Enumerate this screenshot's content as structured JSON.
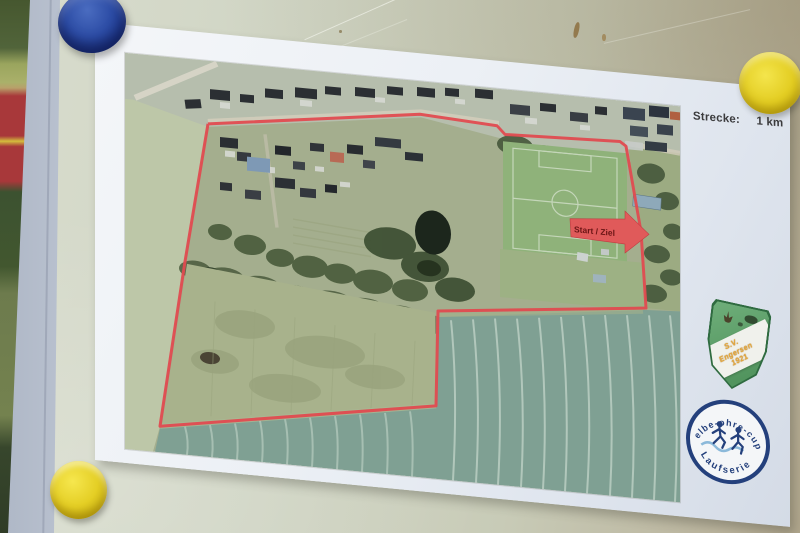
{
  "sheet": {
    "distance_label": "Strecke:",
    "distance_value": "1 km",
    "start_finish_label": "Start / Ziel",
    "route_color": "#e04b50",
    "route_points": "83,63 295,33 372,37 380,45 495,41 501,45 516,129 521,205 313,228 311,323 35,370 60,203 83,63"
  },
  "club_badge": {
    "abbr": "S.V.",
    "name": "Engersen",
    "year": "1921",
    "shield_color": "#5a9c66",
    "text_color": "#e6a83e"
  },
  "cup_logo": {
    "top_text": "elbe-ohre-cup",
    "bottom_text": "Laufserie",
    "ring_color": "#24407c"
  },
  "board": {
    "magnet_colors": {
      "top_left": "#2d4da6",
      "top_right": "#e3cd22",
      "bottom_left": "#e4ce24"
    }
  }
}
